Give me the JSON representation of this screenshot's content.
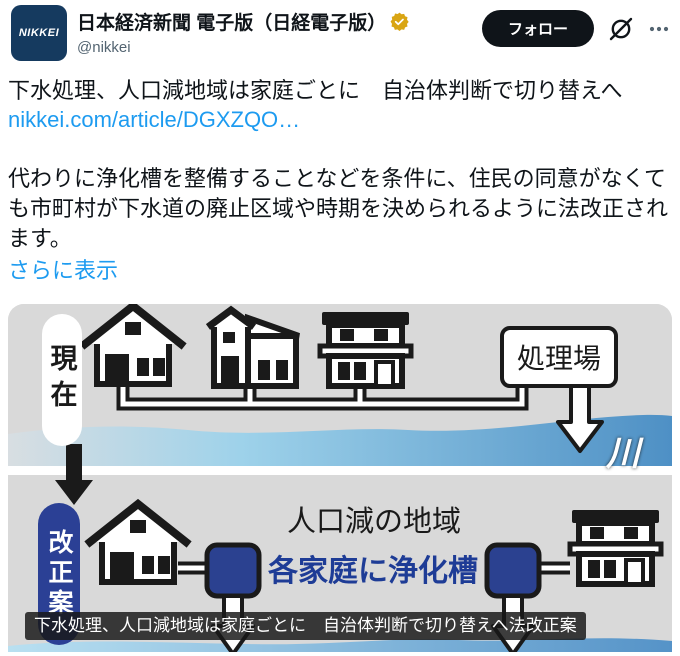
{
  "header": {
    "avatar_text": "NIKKEI",
    "name": "日本経済新聞 電子版（日経電子版）",
    "handle": "@nikkei",
    "verified_badge": "gold-verified-icon",
    "follow_label": "フォロー",
    "grok_icon": "grok-icon",
    "more_icon": "more-icon"
  },
  "tweet": {
    "headline": "下水処理、人口減地域は家庭ごとに　自治体判断で切り替えへ",
    "link": "nikkei.com/article/DGXZQO…",
    "body": "代わりに浄化槽を整備することなどを条件に、住民の同意がなくても市町村が下水道の廃止区域や時期を決められるように法改正されます。",
    "show_more": "さらに表示"
  },
  "infographic": {
    "current_label": "現在",
    "proposal_label": "改正案",
    "plant_label": "処理場",
    "river_label": "川",
    "area_label": "人口減の地域",
    "septic_label": "各家庭に浄化槽",
    "caption": "下水処理、人口減地域は家庭ごとに　自治体判断で切り替えへ法改正案",
    "colors": {
      "avatar_navy": "#153a5f",
      "proposal_blue": "#2b4095",
      "tank_blue": "#2b4190",
      "septic_text_blue": "#1e3c96",
      "river_blue": "#4e90c5",
      "background_gray": "#d9d9d9",
      "link_blue": "#1d9bf0",
      "badge_gold": "#d9a513"
    }
  }
}
